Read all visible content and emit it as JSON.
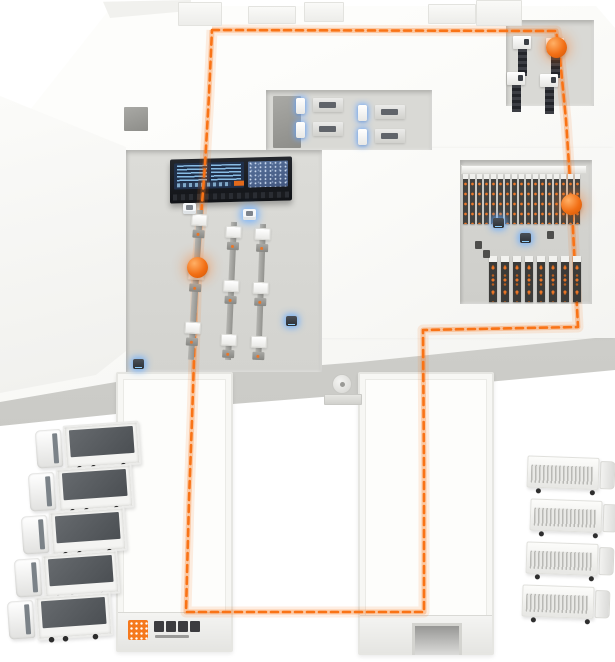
{
  "scene": {
    "label": "smart-logistics-warehouse-isometric-illustration",
    "canvas": {
      "w": 615,
      "h": 662
    }
  },
  "palette": {
    "route_orange": "#f97316",
    "marker_orange": "#ee6f15",
    "glow_blue": "#6eaaff",
    "logo_orange": "#f5791d",
    "platform_white": "#f7f7f4",
    "recess_gray": "#d9d9d5",
    "rack_dark": "#424240",
    "screen_navy": "#20304a",
    "screen_blue": "#4d6b97"
  },
  "route": {
    "style": "dashed-loop",
    "points": [
      [
        212,
        30
      ],
      [
        556,
        31
      ],
      [
        559,
        48
      ],
      [
        566,
        120
      ],
      [
        572,
        210
      ],
      [
        578,
        327
      ],
      [
        423,
        330
      ],
      [
        424,
        470
      ],
      [
        424,
        612
      ],
      [
        186,
        612
      ],
      [
        189,
        500
      ],
      [
        192,
        420
      ],
      [
        197,
        268
      ],
      [
        205,
        165
      ],
      [
        209,
        95
      ],
      [
        212,
        30
      ]
    ]
  },
  "markers": [
    {
      "x": 556,
      "y": 47
    },
    {
      "x": 571,
      "y": 204
    },
    {
      "x": 197,
      "y": 267
    }
  ],
  "agvs": [
    {
      "x": 286,
      "y": 316
    },
    {
      "x": 133,
      "y": 359
    },
    {
      "x": 493,
      "y": 218
    },
    {
      "x": 520,
      "y": 233
    }
  ],
  "totes": [
    {
      "x": 183,
      "y": 203,
      "glow": false
    },
    {
      "x": 243,
      "y": 209,
      "glow": true
    }
  ],
  "wall_openings": [
    {
      "x": 124,
      "y": 107,
      "w": 24,
      "h": 24
    },
    {
      "x": 273,
      "y": 96,
      "w": 28,
      "h": 52
    }
  ],
  "parapet_blocks": [
    {
      "x": 178,
      "y": 2,
      "w": 44,
      "h": 24
    },
    {
      "x": 248,
      "y": 6,
      "w": 48,
      "h": 18
    },
    {
      "x": 304,
      "y": 2,
      "w": 40,
      "h": 20
    },
    {
      "x": 428,
      "y": 4,
      "w": 48,
      "h": 20
    },
    {
      "x": 476,
      "y": 0,
      "w": 46,
      "h": 26
    }
  ],
  "dashboard": {
    "x": 170,
    "y": 158,
    "w": 122,
    "h": 44,
    "left_screen_text_columns": 2,
    "right_screen": "charts",
    "accent_chip": "#e2691b"
  },
  "conveyors": {
    "lines": [
      {
        "x": 190,
        "top": 210,
        "h": 150,
        "lean": 3.5
      },
      {
        "x": 224,
        "top": 222,
        "h": 138,
        "lean": 2.5
      },
      {
        "x": 253,
        "top": 224,
        "h": 136,
        "lean": 2
      }
    ],
    "box_offsets": [
      4,
      58,
      112
    ],
    "joint_offsets": [
      20,
      74,
      128
    ]
  },
  "workstations": [
    {
      "x": 296,
      "y": 96
    },
    {
      "x": 296,
      "y": 120
    },
    {
      "x": 358,
      "y": 103
    },
    {
      "x": 358,
      "y": 127
    }
  ],
  "dock_machines": [
    {
      "x": 512,
      "y": 36
    },
    {
      "x": 545,
      "y": 38
    },
    {
      "x": 506,
      "y": 72
    },
    {
      "x": 539,
      "y": 74
    }
  ],
  "racks": {
    "upper": {
      "x": 463,
      "y": 174,
      "cols": 17,
      "pitch": 7
    },
    "lower": {
      "x": 489,
      "y": 256,
      "cols": 8,
      "pitch": 12
    }
  },
  "rack_devices": [
    {
      "x": 475,
      "y": 241
    },
    {
      "x": 483,
      "y": 250
    },
    {
      "x": 547,
      "y": 231
    }
  ],
  "buildings": {
    "left": {
      "x": 116,
      "y": 372,
      "w": 117,
      "h": 280
    },
    "right": {
      "x": 358,
      "y": 372,
      "w": 136,
      "h": 283
    }
  },
  "logo": {
    "glyph_count": 4,
    "note": "orange mark with illegible dark brand glyphs"
  },
  "vent": {
    "x": 332,
    "y": 374
  },
  "left_trucks": {
    "x": [
      36,
      29,
      22,
      15,
      8
    ],
    "y": [
      424,
      467,
      510,
      553,
      595
    ]
  },
  "right_trucks": {
    "x": [
      527,
      530,
      526,
      522
    ],
    "y": [
      455,
      498,
      541,
      584
    ]
  },
  "counts": {
    "left_trucks": 5,
    "right_trucks": 4,
    "conveyor_lines": 3,
    "workstations": 4,
    "dock_machines": 4,
    "markers": 3
  }
}
